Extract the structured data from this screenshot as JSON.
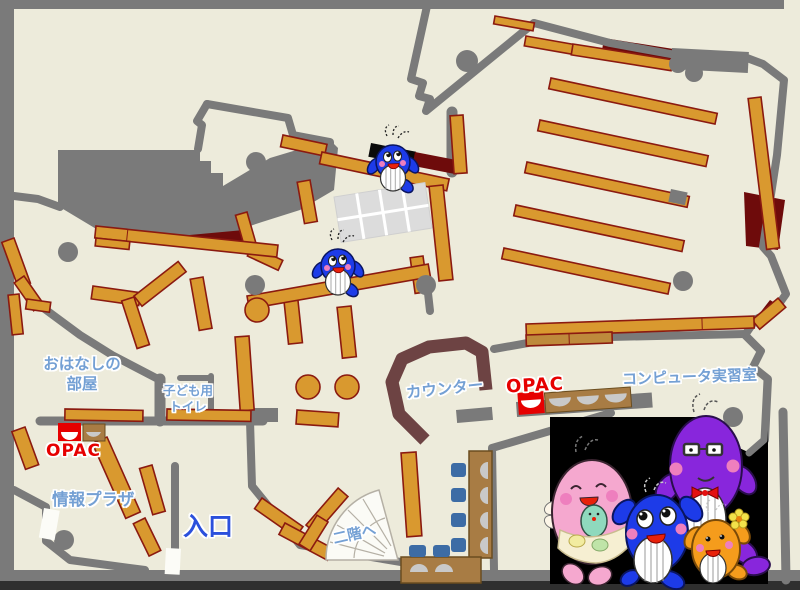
{
  "labels": {
    "storytime_room": "おはなしの\n部屋",
    "kids_toilet": "子ども用\nトイレ",
    "opac_left": "OPAC",
    "info_plaza": "情報プラザ",
    "entrance": "入口",
    "to_second_floor": "二階へ",
    "counter": "カウンター",
    "opac_right": "OPAC",
    "computer_room": "コンピュータ実習室"
  },
  "colors": {
    "floor": "#EDEBDB",
    "wall_gray": "#7A7A7A",
    "shelf_tan": "#D9992F",
    "shelf_border": "#8B1A10",
    "accent_dark_red": "#6E0B0B",
    "counter_brown": "#6D4343",
    "desk_brown": "#A87C44",
    "chair_blue": "#3D6CA5",
    "seat_gray": "#C9C9C9",
    "opac_red": "#E60000",
    "label_blue": "#74A0D4",
    "entrance_blue": "#2B50DC",
    "mascot_blue": "#1D3BE8",
    "mascot_pink": "#F5A8CF",
    "mascot_purple": "#8826DC",
    "mascot_orange": "#F59C1C"
  },
  "icons": {
    "small_whale": "whale-mascot-icon",
    "whale_family": "whale-family-mascots-illustration",
    "stairs": "spiral-stairs-icon",
    "opac_terminal": "opac-terminal-icon"
  }
}
